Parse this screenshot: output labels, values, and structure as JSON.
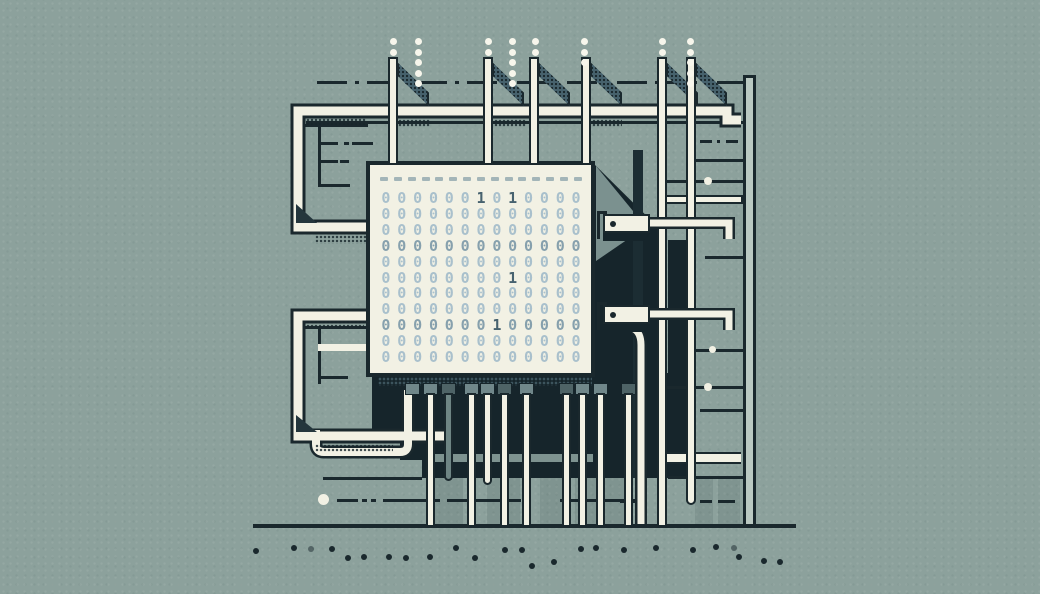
{
  "palette": {
    "background": "#8ca19c",
    "outline_ink": "#1a282d",
    "cream_white": "#f2f1e4",
    "shadow_black": "#16252b",
    "panel_gray": "#7b918f",
    "flag_teal": "#46616c",
    "rail_light": "#bac9c2",
    "trace_gray": "#7e9390",
    "digit_light": "#a9c0cc",
    "digit_mid": "#86a0ad",
    "digit_one_dark": "#47626f",
    "pad_a": "#70878a",
    "pad_b": "#4e6366",
    "gray_pin": "#6e8584"
  },
  "chip": {
    "header_dash_count": 15,
    "binary_rows": [
      "0000001010000",
      "0000000000000",
      "0000000000000",
      "0000000000000",
      "0000000000000",
      "0000000010000",
      "0000000000000",
      "0000000000000",
      "0000000100000",
      "0000000000000",
      "0000000000000"
    ]
  },
  "figure": {
    "top_pins": [
      {
        "x": 388,
        "h": 103
      },
      {
        "x": 483,
        "h": 103
      },
      {
        "x": 529,
        "h": 103
      },
      {
        "x": 581,
        "h": 103
      },
      {
        "x": 657,
        "h": 470
      },
      {
        "x": 686,
        "h": 448,
        "round": true
      }
    ],
    "dot_columns": [
      {
        "x": 393,
        "n": 2
      },
      {
        "x": 418,
        "n": 5
      },
      {
        "x": 488,
        "n": 2
      },
      {
        "x": 512,
        "n": 5
      },
      {
        "x": 535,
        "n": 2
      },
      {
        "x": 584,
        "n": 3
      },
      {
        "x": 662,
        "n": 2
      },
      {
        "x": 690,
        "n": 5
      }
    ],
    "pads_x": [
      405,
      423,
      441,
      464,
      480,
      497,
      519,
      559,
      575,
      593,
      621
    ],
    "pad_shades": [
      "a",
      "a",
      "b",
      "a",
      "a",
      "b",
      "a",
      "b",
      "a",
      "a",
      "b"
    ],
    "bottom_pins": [
      {
        "x": 426,
        "h": 134
      },
      {
        "x": 444,
        "h": 88,
        "gray": true,
        "round": true
      },
      {
        "x": 467,
        "h": 134
      },
      {
        "x": 483,
        "h": 92,
        "round": true
      },
      {
        "x": 500,
        "h": 134
      },
      {
        "x": 522,
        "h": 134
      },
      {
        "x": 562,
        "h": 134
      },
      {
        "x": 578,
        "h": 134
      },
      {
        "x": 596,
        "h": 134
      },
      {
        "x": 624,
        "h": 134
      }
    ],
    "rungs": [
      {
        "x": 306,
        "y": 121,
        "w": 437
      },
      {
        "x": 667,
        "y": 180,
        "w": 76
      },
      {
        "x": 695,
        "y": 159,
        "w": 48
      },
      {
        "x": 705,
        "y": 256,
        "w": 38
      },
      {
        "x": 695,
        "y": 349,
        "w": 48
      },
      {
        "x": 667,
        "y": 386,
        "w": 76
      },
      {
        "x": 700,
        "y": 409,
        "w": 43
      }
    ],
    "dash_segments": [
      [
        337,
        499,
        21
      ],
      [
        362,
        499,
        5
      ],
      [
        371,
        499,
        5
      ],
      [
        383,
        499,
        57
      ],
      [
        447,
        499,
        74
      ],
      [
        560,
        499,
        80
      ],
      [
        620,
        500,
        20
      ],
      [
        700,
        500,
        12
      ],
      [
        718,
        500,
        17
      ],
      [
        323,
        477,
        99
      ],
      [
        668,
        476,
        75
      ]
    ],
    "signal_dots": [
      [
        704,
        177,
        8
      ],
      [
        709,
        346,
        7
      ],
      [
        704,
        383,
        8
      ]
    ],
    "ground_dots": [
      [
        253,
        548,
        1
      ],
      [
        291,
        545,
        1
      ],
      [
        308,
        546,
        0.5
      ],
      [
        329,
        546,
        1
      ],
      [
        345,
        555,
        1
      ],
      [
        361,
        554,
        1
      ],
      [
        386,
        554,
        1
      ],
      [
        403,
        555,
        1
      ],
      [
        427,
        554,
        1
      ],
      [
        453,
        545,
        1
      ],
      [
        472,
        555,
        1
      ],
      [
        502,
        547,
        1
      ],
      [
        519,
        547,
        1
      ],
      [
        529,
        563,
        1
      ],
      [
        551,
        559,
        1
      ],
      [
        578,
        546,
        1
      ],
      [
        593,
        545,
        1
      ],
      [
        621,
        547,
        1
      ],
      [
        653,
        545,
        1
      ],
      [
        690,
        547,
        1
      ],
      [
        713,
        544,
        1
      ],
      [
        731,
        545,
        0.5
      ],
      [
        736,
        554,
        1
      ],
      [
        761,
        558,
        1
      ],
      [
        777,
        559,
        1
      ]
    ],
    "shade_columns": [
      [
        433,
        478,
        30,
        46
      ],
      [
        487,
        478,
        33,
        46
      ],
      [
        540,
        478,
        28,
        46
      ],
      [
        575,
        478,
        50,
        46
      ],
      [
        695,
        478,
        18,
        46
      ],
      [
        718,
        478,
        22,
        46
      ]
    ]
  }
}
